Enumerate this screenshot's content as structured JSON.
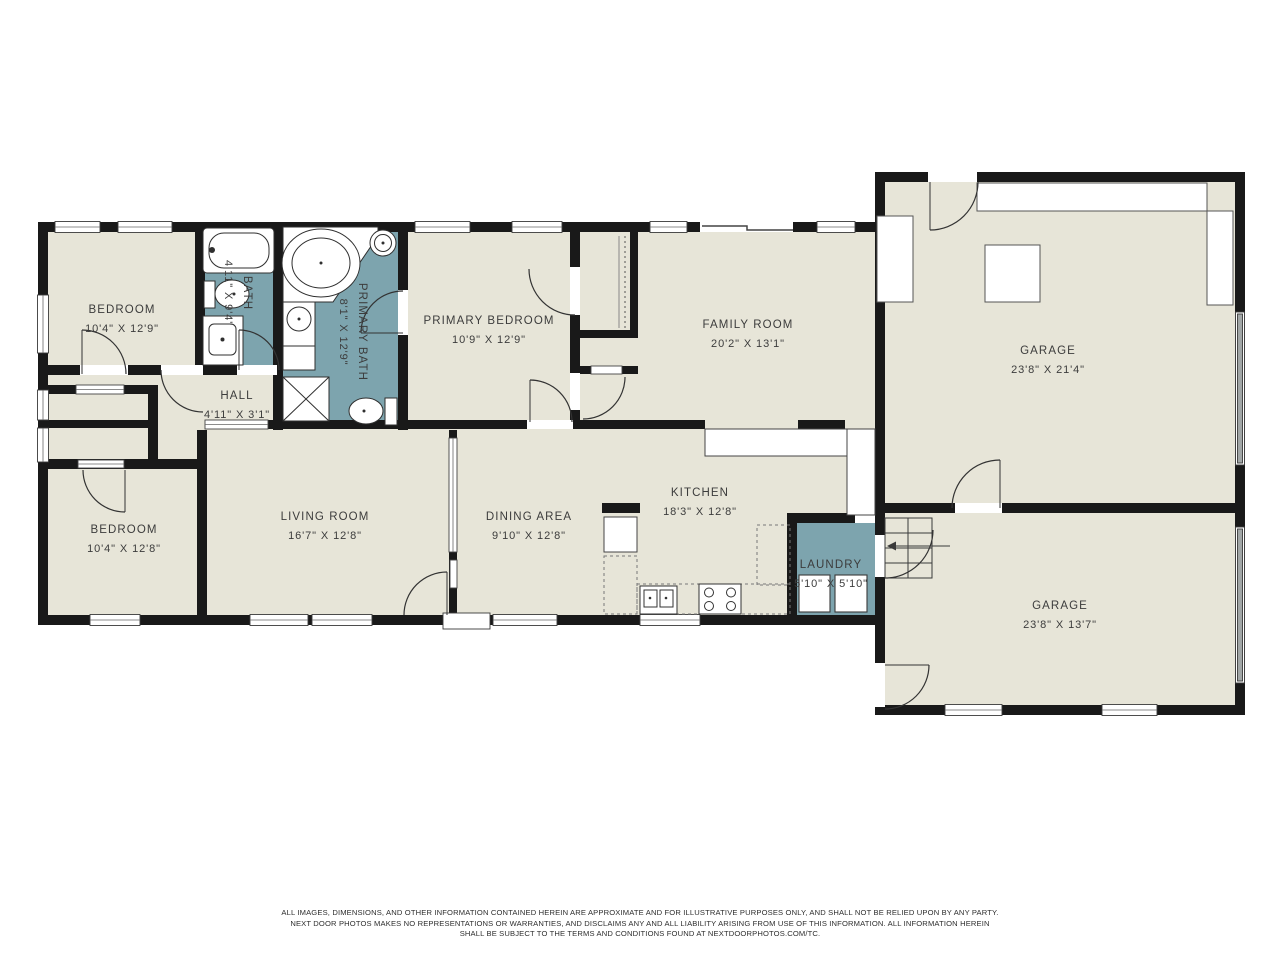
{
  "plan": {
    "colors": {
      "floor": "#e7e5d8",
      "wet_room": "#7da4ae",
      "wall": "#191919",
      "label_text": "#3c3c3c",
      "garage_door": "#a2a7a7"
    },
    "rooms": [
      {
        "name": "BEDROOM",
        "dims": "10'4\" X 12'9\""
      },
      {
        "name": "BATH",
        "dims": "4'11\" X 9'4\""
      },
      {
        "name": "PRIMARY BATH",
        "dims": "8'1\" X 12'9\""
      },
      {
        "name": "HALL",
        "dims": "4'11\" X 3'1\""
      },
      {
        "name": "PRIMARY BEDROOM",
        "dims": "10'9\" X 12'9\""
      },
      {
        "name": "FAMILY ROOM",
        "dims": "20'2\" X 13'1\""
      },
      {
        "name": "GARAGE",
        "dims": "23'8\" X 21'4\""
      },
      {
        "name": "BEDROOM",
        "dims": "10'4\" X 12'8\""
      },
      {
        "name": "LIVING ROOM",
        "dims": "16'7\" X 12'8\""
      },
      {
        "name": "DINING AREA",
        "dims": "9'10\" X 12'8\""
      },
      {
        "name": "KITCHEN",
        "dims": "18'3\" X 12'8\""
      },
      {
        "name": "LAUNDRY",
        "dims": "5'10\" X 5'10\""
      },
      {
        "name": "GARAGE",
        "dims": "23'8\" X 13'7\""
      }
    ],
    "disclaimer": {
      "line1": "ALL IMAGES, DIMENSIONS, AND OTHER INFORMATION CONTAINED HEREIN ARE APPROXIMATE AND FOR ILLUSTRATIVE PURPOSES ONLY, AND SHALL NOT BE RELIED UPON BY ANY PARTY.",
      "line2": "NEXT DOOR PHOTOS MAKES NO REPRESENTATIONS OR WARRANTIES, AND DISCLAIMS ANY AND ALL LIABILITY ARISING FROM USE OF THIS INFORMATION. ALL INFORMATION HEREIN",
      "line3": "SHALL BE SUBJECT TO THE TERMS AND CONDITIONS FOUND AT NEXTDOORPHOTOS.COM/TC."
    }
  }
}
